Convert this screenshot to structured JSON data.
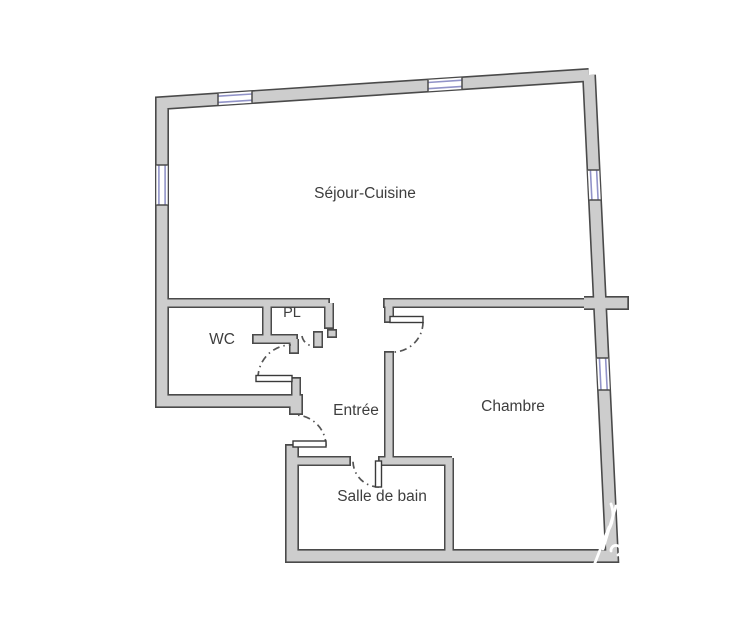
{
  "plan": {
    "canvas": {
      "width": 750,
      "height": 630,
      "background": "#ffffff"
    },
    "colors": {
      "wall_fill": "#cdcdcd",
      "wall_outline": "#4a4a4a",
      "window_line": "#9193c8",
      "door_leaf_fill": "#ffffff",
      "door_leaf_outline": "#3a3a3a",
      "door_arc": "#555555",
      "label_text": "#3e3e3e",
      "watermark": "#ffffff"
    },
    "rooms": [
      {
        "id": "sejour-cuisine",
        "label": "Séjour-Cuisine",
        "x": 365,
        "y": 198,
        "font_size": 15.5
      },
      {
        "id": "wc",
        "label": "WC",
        "x": 222,
        "y": 344,
        "font_size": 15.5
      },
      {
        "id": "pl",
        "label": "PL",
        "x": 292,
        "y": 317,
        "font_size": 14.5
      },
      {
        "id": "entree",
        "label": "Entrée",
        "x": 356,
        "y": 415,
        "font_size": 15.5
      },
      {
        "id": "chambre",
        "label": "Chambre",
        "x": 513,
        "y": 411,
        "font_size": 15.5
      },
      {
        "id": "salle-de-bain",
        "label": "Salle de bain",
        "x": 382,
        "y": 501,
        "font_size": 15.5
      }
    ],
    "walls": {
      "exterior_dark_width": 14,
      "exterior_light_width": 10.8,
      "interior_dark_width": 10,
      "interior_light_width": 7,
      "exterior": [
        {
          "pts": [
            [
              589,
              75
            ],
            [
              162,
              103
            ],
            [
              162,
              401
            ],
            [
              296,
              401
            ],
            [
              296,
              415
            ]
          ],
          "trim_end": true
        },
        {
          "pts": [
            [
              589,
              75
            ],
            [
              612,
              556
            ],
            [
              292,
              556
            ],
            [
              292,
              444
            ]
          ],
          "trim_end": true
        },
        {
          "pts": [
            [
              584,
              303
            ],
            [
              629,
              303
            ]
          ],
          "trim_end": true
        }
      ],
      "interior": [
        {
          "pts": [
            [
              162,
              303
            ],
            [
              330,
              303
            ]
          ],
          "trim_end": true
        },
        {
          "pts": [
            [
              383,
              303
            ],
            [
              600,
              303
            ]
          ],
          "trim_start": true
        },
        {
          "pts": [
            [
              267,
              303
            ],
            [
              267,
              339
            ]
          ]
        },
        {
          "pts": [
            [
              252,
              339
            ],
            [
              298,
              339
            ]
          ],
          "trim_start": true,
          "trim_end": true
        },
        {
          "pts": [
            [
              294,
              339
            ],
            [
              294,
              354
            ]
          ],
          "trim_end": true
        },
        {
          "pts": [
            [
              329,
              303
            ],
            [
              329,
              329
            ]
          ],
          "trim_end": true
        },
        {
          "pts": [
            [
              389,
              303
            ],
            [
              389,
              323
            ]
          ],
          "trim_end": true
        },
        {
          "pts": [
            [
              389,
              351
            ],
            [
              389,
              463
            ]
          ],
          "trim_start": true
        },
        {
          "pts": [
            [
              292,
              461
            ],
            [
              351,
              461
            ]
          ],
          "trim_end": true
        },
        {
          "pts": [
            [
              378,
              461
            ],
            [
              452,
              461
            ]
          ],
          "trim_start": true
        },
        {
          "pts": [
            [
              449,
              458
            ],
            [
              449,
              558
            ]
          ]
        },
        {
          "pts": [
            [
              296,
              377
            ],
            [
              296,
              402
            ]
          ],
          "trim_start": true
        },
        {
          "pts": [
            [
              318,
              331
            ],
            [
              318,
              348
            ]
          ],
          "trim_start": true,
          "trim_end": true
        },
        {
          "pts": [
            [
              332,
              329
            ],
            [
              332,
              338
            ]
          ],
          "trim_start": true,
          "trim_end": true
        }
      ]
    },
    "windows": [
      {
        "id": "window-top-left",
        "x1": 218,
        "y1": 99.3,
        "x2": 252,
        "y2": 97.1,
        "nx": 0,
        "ny": 1
      },
      {
        "id": "window-top-right",
        "x1": 428,
        "y1": 85.6,
        "x2": 462,
        "y2": 83.3,
        "nx": 0,
        "ny": 1
      },
      {
        "id": "window-left",
        "x1": 162,
        "y1": 165,
        "x2": 162,
        "y2": 205,
        "nx": 1,
        "ny": 0
      },
      {
        "id": "window-right-upper",
        "x1": 593.5,
        "y1": 170,
        "x2": 595,
        "y2": 200,
        "nx": 1,
        "ny": 0
      },
      {
        "id": "window-right-lower",
        "x1": 602.5,
        "y1": 358,
        "x2": 604.1,
        "y2": 390,
        "nx": 1,
        "ny": 0
      }
    ],
    "doors": [
      {
        "id": "wc-door",
        "leaf": {
          "x": 256,
          "y": 375.5,
          "w": 36,
          "h": 6
        },
        "arc": "M258,378 A33,33 0 0 1 291,345"
      },
      {
        "id": "chambre-door",
        "leaf": {
          "x": 390,
          "y": 316.5,
          "w": 33,
          "h": 6
        },
        "arc": "M423,322 A30,30 0 0 1 392,352"
      },
      {
        "id": "entrance-door",
        "leaf": {
          "x": 293,
          "y": 441,
          "w": 33,
          "h": 6
        },
        "arc": "M326,446 A31,31 0 0 0 295,415"
      },
      {
        "id": "bathroom-door",
        "leaf": {
          "x": 375.5,
          "y": 461,
          "w": 6,
          "h": 26
        },
        "arc": "M379,487 A26,26 0 0 1 353,461"
      },
      {
        "id": "pl-door",
        "leaf": null,
        "arc": "M302,336 A12,12 0 0 0 313,346"
      }
    ],
    "watermark_strokes": [
      {
        "d": "M603,549 L616,506"
      },
      {
        "d": "M593,568 L609,527"
      },
      {
        "d": "M608,531 Q616,518 611,504"
      },
      {
        "d": "M611,551 a5,5 0 1 1 7,4"
      }
    ]
  }
}
